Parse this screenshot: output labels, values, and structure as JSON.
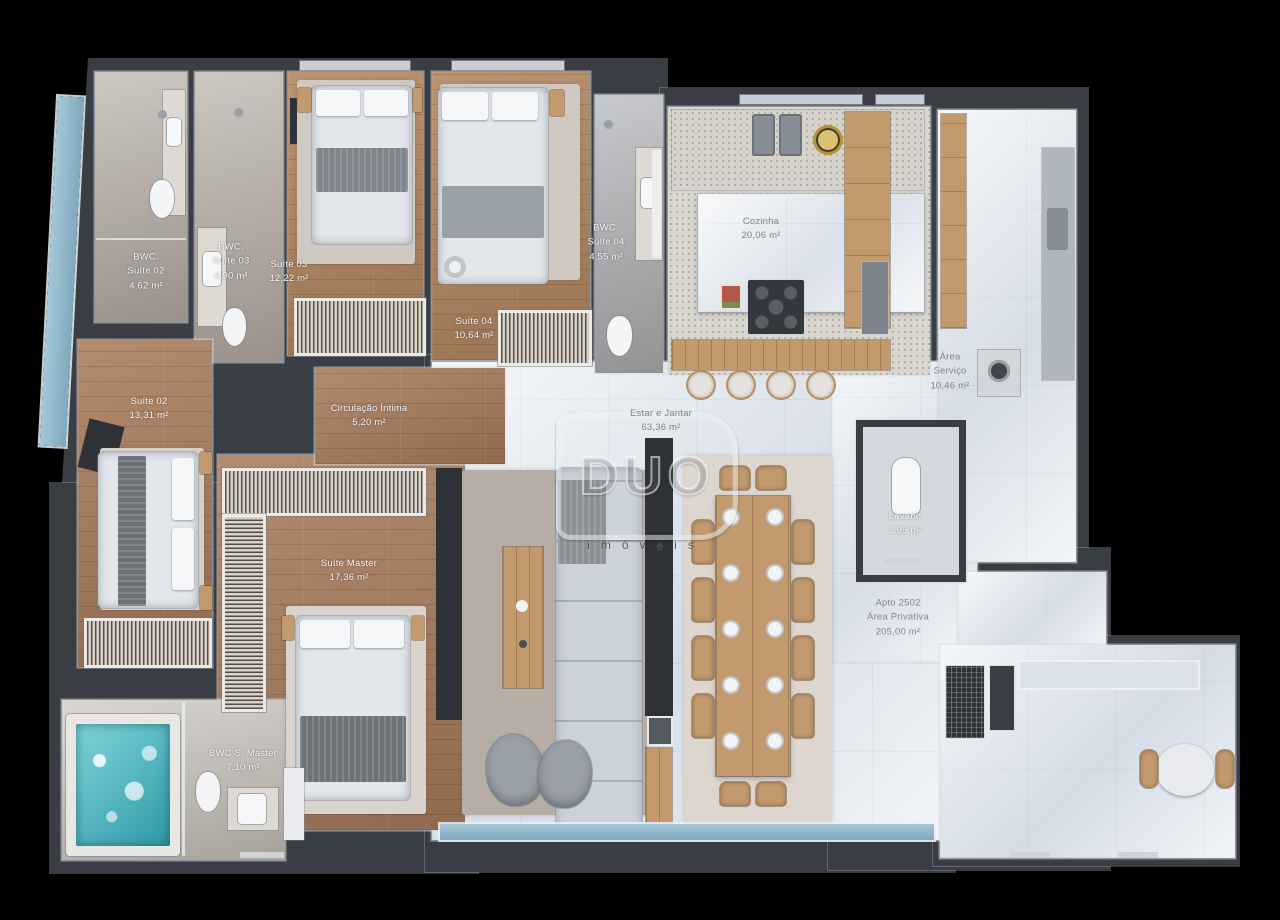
{
  "watermark": {
    "logo": "DUO",
    "subtitle": "imóveis"
  },
  "palette": {
    "wall": "#3a3e44",
    "wood": "#a87c5c",
    "marble": "#e7ebf1",
    "water": "#49b4bf",
    "gold": "#b9952f"
  },
  "labels": {
    "bwc_suite02": {
      "l1": "BWC.",
      "l2": "Suíte 02",
      "l3": "4,62 m²"
    },
    "bwc_suite03": {
      "l1": "BWC.",
      "l2": "Suíte 03",
      "l3": "4,90 m²"
    },
    "suite03": {
      "l1": "Suíte 03",
      "l2": "12,22 m²"
    },
    "suite04": {
      "l1": "Suíte 04",
      "l2": "10,64 m²"
    },
    "bwc_suite04": {
      "l1": "BWC.",
      "l2": "Suíte 04",
      "l3": "4,55 m²"
    },
    "cozinha": {
      "l1": "Cozinha",
      "l2": "20,06 m²"
    },
    "area_servico": {
      "l1": "Área",
      "l2": "Serviço",
      "l3": "10,46 m²"
    },
    "suite02": {
      "l1": "Suíte 02",
      "l2": "13,31 m²"
    },
    "circulacao": {
      "l1": "Circulação Íntima",
      "l2": "5,20 m²"
    },
    "estar_jantar": {
      "l1": "Estar e Jantar",
      "l2": "63,36 m²"
    },
    "suite_master": {
      "l1": "Suíte Master",
      "l2": "17,36 m²"
    },
    "bwc_master": {
      "l1": "BWC S. Master",
      "l2": "7,10 m²"
    },
    "lavabo": {
      "l1": "Lavabo",
      "l2": "1,95 m²"
    },
    "apto": {
      "l1": "Apto 2502",
      "l2": "Área Privativa",
      "l3": "205,00 m²"
    }
  }
}
